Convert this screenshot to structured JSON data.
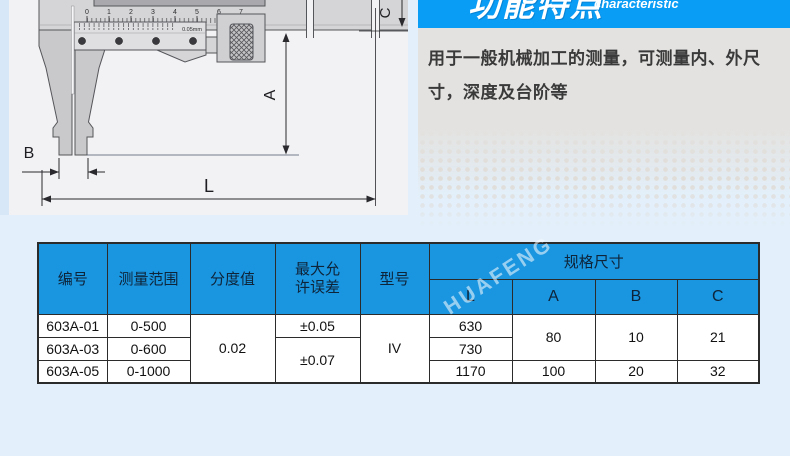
{
  "feature_section": {
    "title_cn": "功能特点",
    "title_en": "characteristic",
    "description": "用于一般机械加工的测量，可测量内、外尺寸，深度及台阶等",
    "banner_color": "#0A9DF6"
  },
  "diagram": {
    "dimension_labels": {
      "A": "A",
      "B": "B",
      "C": "C",
      "L": "L"
    },
    "scale_numbers": [
      "0",
      "1",
      "2",
      "3",
      "4",
      "5",
      "6",
      "7"
    ],
    "vernier_label": "0.05mm"
  },
  "watermark": {
    "brand": "HUAFENG"
  },
  "spec_table": {
    "header_color": "#1A95E0",
    "col_headers": {
      "id": "编号",
      "range": "测量范围",
      "graduation": "分度值",
      "error_line1": "最大允",
      "error_line2": "许误差",
      "model": "型号",
      "dims_group": "规格尺寸",
      "L": "L",
      "A": "A",
      "B": "B",
      "C": "C"
    },
    "rows": {
      "r1": {
        "id": "603A-01",
        "range": "0-500",
        "error": "±0.05",
        "L": "630"
      },
      "r2": {
        "id": "603A-03",
        "range": "0-600",
        "L": "730"
      },
      "r3": {
        "id": "603A-05",
        "range": "0-1000",
        "L": "1170",
        "A": "100",
        "B": "20",
        "C": "32"
      },
      "merged": {
        "graduation_all": "0.02",
        "error_r2r3": "±0.07",
        "model_all": "IV",
        "A_r1r2": "80",
        "B_r1r2": "10",
        "C_r1r2": "21"
      }
    }
  }
}
